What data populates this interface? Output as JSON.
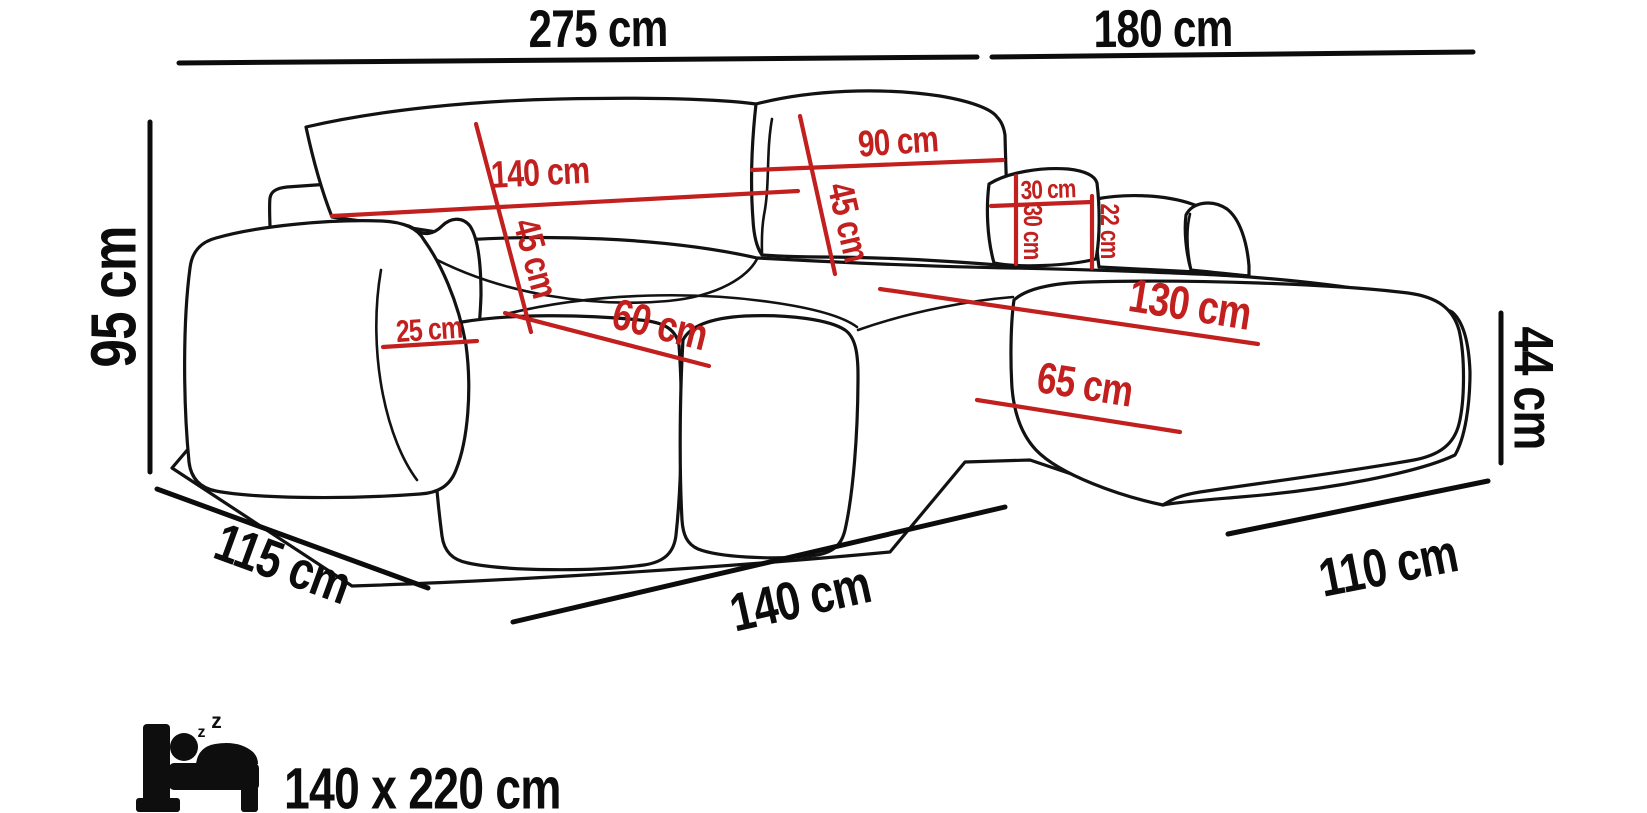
{
  "title": "Corner sofa dimensions diagram",
  "colors": {
    "line": "#121212",
    "dimension_red": "#c2201e",
    "dimension_black": "#0c0c0c",
    "background": "#ffffff"
  },
  "dimensions": {
    "overall_width_left": "275 cm",
    "overall_width_right": "180 cm",
    "overall_height": "95 cm",
    "side_depth": "115 cm",
    "front_width": "140 cm",
    "chaise_front_width": "110 cm",
    "seat_height": "44 cm",
    "backrest_left_width": "140 cm",
    "backrest_left_height": "45 cm",
    "backrest_right_width": "90 cm",
    "backrest_right_height": "45 cm",
    "pillow_width": "30 cm",
    "pillow_height": "30 cm",
    "side_back_height": "22 cm",
    "armrest_width": "25 cm",
    "seat_depth": "60 cm",
    "chaise_length": "130 cm",
    "chaise_seat_width": "65 cm"
  },
  "sleeping": {
    "size": "140 x 220 cm",
    "z_small": "z",
    "z_big": "z"
  }
}
